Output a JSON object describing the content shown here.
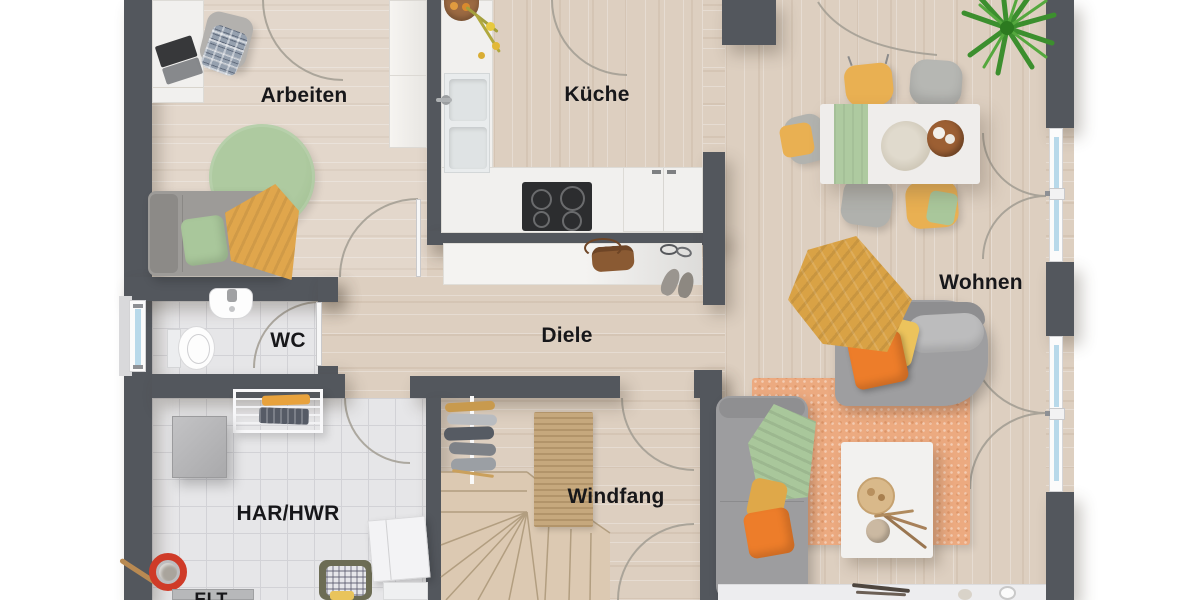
{
  "rooms": {
    "arbeiten": {
      "label": "Arbeiten"
    },
    "kueche": {
      "label": "Küche"
    },
    "wohnen": {
      "label": "Wohnen"
    },
    "wc": {
      "label": "WC"
    },
    "diele": {
      "label": "Diele"
    },
    "har_hwr": {
      "label": "HAR/HWR"
    },
    "windfang": {
      "label": "Windfang"
    },
    "elt": {
      "label": "ELT"
    }
  },
  "palette": {
    "wall": "#53575d",
    "wood_floor": "#ddcfc0",
    "tile_floor": "#e6e6e8",
    "accent_green": "#a9c79b",
    "accent_mustard": "#e0a64c",
    "accent_orange": "#ed7d2a",
    "rug_terracotta": "#ecaa80",
    "glass_blue": "#b8d9ea",
    "stair_wood": "#dcc9b2"
  }
}
